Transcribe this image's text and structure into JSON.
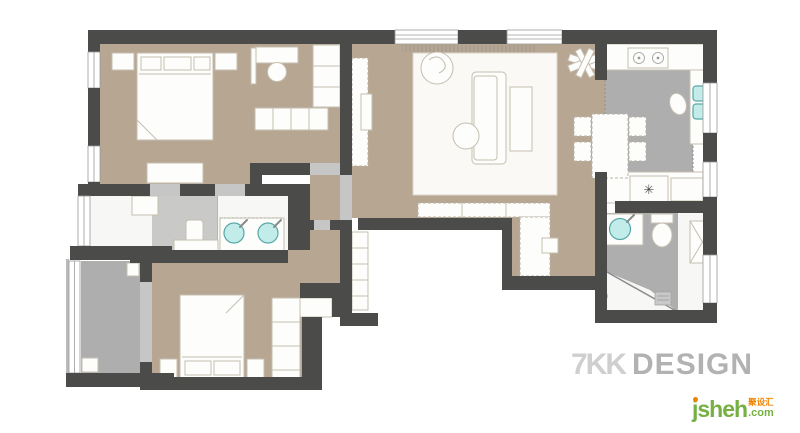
{
  "watermark": {
    "brand": "7KK",
    "word": "DESIGN"
  },
  "site_logo": {
    "name": "jsheh",
    "cjk": "聚设汇",
    "tld": ".com"
  },
  "appliance": {
    "star_glyph": "✳"
  },
  "palette": {
    "wall": "#4b4b4a",
    "floor_tan": "#b7a692",
    "floor_gray": "#aeaeae",
    "floor_light": "#c9c9c8",
    "door_gray": "#c6c6c6",
    "sink_teal": "#c2ece9",
    "sink_teal_border": "#56a7a7",
    "furniture_outline": "#c5beb1",
    "watermark_brand": "#cfcfcf",
    "watermark_word": "#b2b2b2",
    "logo_green": "#76b043",
    "logo_orange": "#f08300"
  }
}
